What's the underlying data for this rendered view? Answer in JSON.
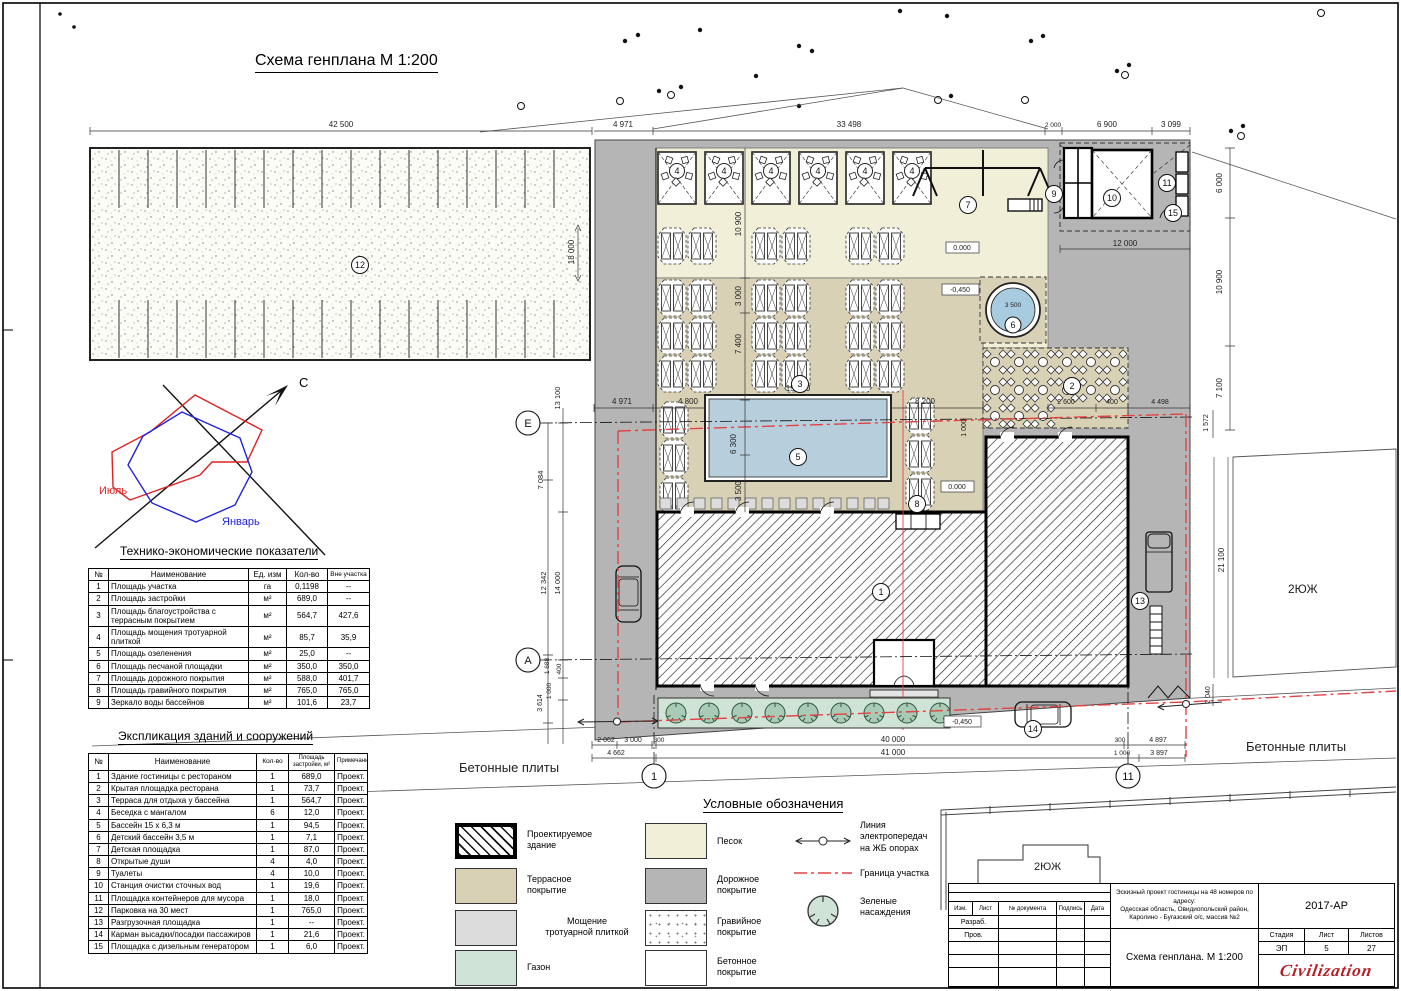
{
  "title": "Схема генплана М 1:200",
  "windrose": {
    "north": "С",
    "july": "Июль",
    "january": "Январь"
  },
  "labels": {
    "plates_left": "Бетонные плиты",
    "plates_right": "Бетонные плиты",
    "neighbor_big": "2ЮЖ",
    "neighbor_small": "2ЮЖ"
  },
  "tep": {
    "heading": "Технико-экономические показатели",
    "headers": [
      "№",
      "Наименование",
      "Ед. изм",
      "Кол-во",
      "Вне участка"
    ],
    "rows": [
      [
        "1",
        "Площадь участка",
        "га",
        "0,1198",
        "--"
      ],
      [
        "2",
        "Площадь застройки",
        "м²",
        "689,0",
        "--"
      ],
      [
        "3",
        "Площадь благоустройства с террасным покрытием",
        "м²",
        "564,7",
        "427,6"
      ],
      [
        "4",
        "Площадь мощения тротуарной плиткой",
        "м²",
        "85,7",
        "35,9"
      ],
      [
        "5",
        "Площадь озеленения",
        "м²",
        "25,0",
        "--"
      ],
      [
        "6",
        "Площадь песчаной площадки",
        "м²",
        "350,0",
        "350,0"
      ],
      [
        "7",
        "Площадь дорожного покрытия",
        "м²",
        "588,0",
        "401,7"
      ],
      [
        "8",
        "Площадь гравийного покрытия",
        "м²",
        "765,0",
        "765,0"
      ],
      [
        "9",
        "Зеркало воды бассейнов",
        "м²",
        "101,6",
        "23,7"
      ]
    ]
  },
  "explication": {
    "heading": "Экспликация зданий и сооружений",
    "headers": [
      "№",
      "Наименование",
      "Кол-во",
      "Площадь застройки, м²",
      "Примечание"
    ],
    "rows": [
      [
        "1",
        "Здание гостиницы с рестораном",
        "1",
        "689,0",
        "Проект."
      ],
      [
        "2",
        "Крытая площадка ресторана",
        "1",
        "73,7",
        "Проект."
      ],
      [
        "3",
        "Терраса для отдыха у бассейна",
        "1",
        "564,7",
        "Проект."
      ],
      [
        "4",
        "Беседка с мангалом",
        "6",
        "12,0",
        "Проект."
      ],
      [
        "5",
        "Бассейн 15 х 6,3 м",
        "1",
        "94,5",
        "Проект."
      ],
      [
        "6",
        "Детский бассейн 3,5 м",
        "1",
        "7,1",
        "Проект."
      ],
      [
        "7",
        "Детская площадка",
        "1",
        "87,0",
        "Проект."
      ],
      [
        "8",
        "Открытые души",
        "4",
        "4,0",
        "Проект."
      ],
      [
        "9",
        "Туалеты",
        "4",
        "10,0",
        "Проект."
      ],
      [
        "10",
        "Станция очистки сточных вод",
        "1",
        "19,6",
        "Проект."
      ],
      [
        "11",
        "Площадка контейнеров для мусора",
        "1",
        "18,0",
        "Проект."
      ],
      [
        "12",
        "Парковка на 30 мест",
        "1",
        "765,0",
        "Проект."
      ],
      [
        "13",
        "Разгрузочная площадка",
        "1",
        "--",
        "Проект."
      ],
      [
        "14",
        "Карман высадки/посадки пассажиров",
        "1",
        "21,6",
        "Проект."
      ],
      [
        "15",
        "Площадка с дизельным генератором",
        "1",
        "6,0",
        "Проект."
      ]
    ]
  },
  "legend": {
    "heading": "Условные обозначения",
    "items": [
      {
        "label": "Проектируемое\nздание"
      },
      {
        "label": "Террасное\nпокрытие"
      },
      {
        "label": "Мощение\nтротуарной плиткой"
      },
      {
        "label": "Газон"
      },
      {
        "label": "Песок"
      },
      {
        "label": "Дорожное\nпокрытие"
      },
      {
        "label": "Гравийное\nпокрытие"
      },
      {
        "label": "Бетонное\nпокрытие"
      },
      {
        "label": "Линия\nэлектропередач\nна ЖБ опорах"
      },
      {
        "label": "Граница участка"
      },
      {
        "label": "Зеленые\nнасаждения"
      }
    ]
  },
  "titleblock": {
    "code": "2017-АР",
    "project": "Эскизный проект гостиницы на 48 номеров по адресу:\nОдесская область, Овидиопольский район,\nКаролино - Бугазский о/с, массив №2",
    "doc_title": "Схема генплана. М 1:200",
    "cols": [
      "Изм.",
      "Лист",
      "№ документа",
      "Подпись",
      "Дата"
    ],
    "row1": "Разраб.",
    "row2": "Пров.",
    "stage_h": "Стадия",
    "sheet_h": "Лист",
    "sheets_h": "Листов",
    "stage": "ЭП",
    "sheet": "5",
    "sheets": "27",
    "logo": "Civilization"
  },
  "dims": {
    "d42500": "42 500",
    "d4971t": "4 971",
    "d33498": "33 498",
    "d2000": "2 000",
    "d6900": "6 900",
    "d3099": "3 099",
    "d18000": "18 000",
    "d12000": "12 000",
    "d6000": "6 000",
    "d10900r": "10 900",
    "d7100": "7 100",
    "d10900": "10 900",
    "d3000": "3 000",
    "d7400": "7 400",
    "d3500t": "3 500",
    "d6300": "6 300",
    "d15000": "15 000",
    "d4800": "4 800",
    "d8200": "8 200",
    "d4971e": "4 971",
    "d2600": "2 600",
    "d400r": "400",
    "d4498": "4 498",
    "d1572": "1 572",
    "d1000r": "1 000",
    "d13100": "13 100",
    "d7084": "7 084",
    "d12342": "12 342",
    "d14000": "14 000",
    "d1688": "1 688",
    "d400": "400",
    "d1000l": "1 000",
    "d3614": "3 614",
    "d2062": "2 062",
    "d3000b": "3 000",
    "d300a": "300",
    "d40000": "40 000",
    "d300b": "300",
    "d4897": "4 897",
    "d4662": "4 662",
    "d41000": "41 000",
    "d1000b": "1 000",
    "d3897": "3 897",
    "d21100": "21 100",
    "d2040": "2 040",
    "d3500k": "3 500",
    "lvl0a": "0.000",
    "lvl0b": "0.000",
    "lvl45a": "-0,450",
    "lvl45b": "-0,450"
  },
  "callouts": {
    "c1": "1",
    "c2": "2",
    "c3": "3",
    "c4": "4",
    "c5": "5",
    "c6": "6",
    "c7": "7",
    "c8": "8",
    "c9": "9",
    "c10": "10",
    "c11": "11",
    "c12": "12",
    "c13": "13",
    "c14": "14",
    "c15": "15"
  },
  "grid": {
    "gE": "Е",
    "gA": "А",
    "g1": "1",
    "g11": "11"
  },
  "colors": {
    "sand": "#f2efd9",
    "terrace": "#d9d1b6",
    "road": "#b5b5b5",
    "lawn": "#cfe3d6",
    "tree": "#a9cab5",
    "pool": "#b7cfdd",
    "paving": "#dcdcdc",
    "boundary": "#e04343",
    "july": "#dd2222",
    "january": "#2222dd",
    "logo": "#b51f24"
  }
}
